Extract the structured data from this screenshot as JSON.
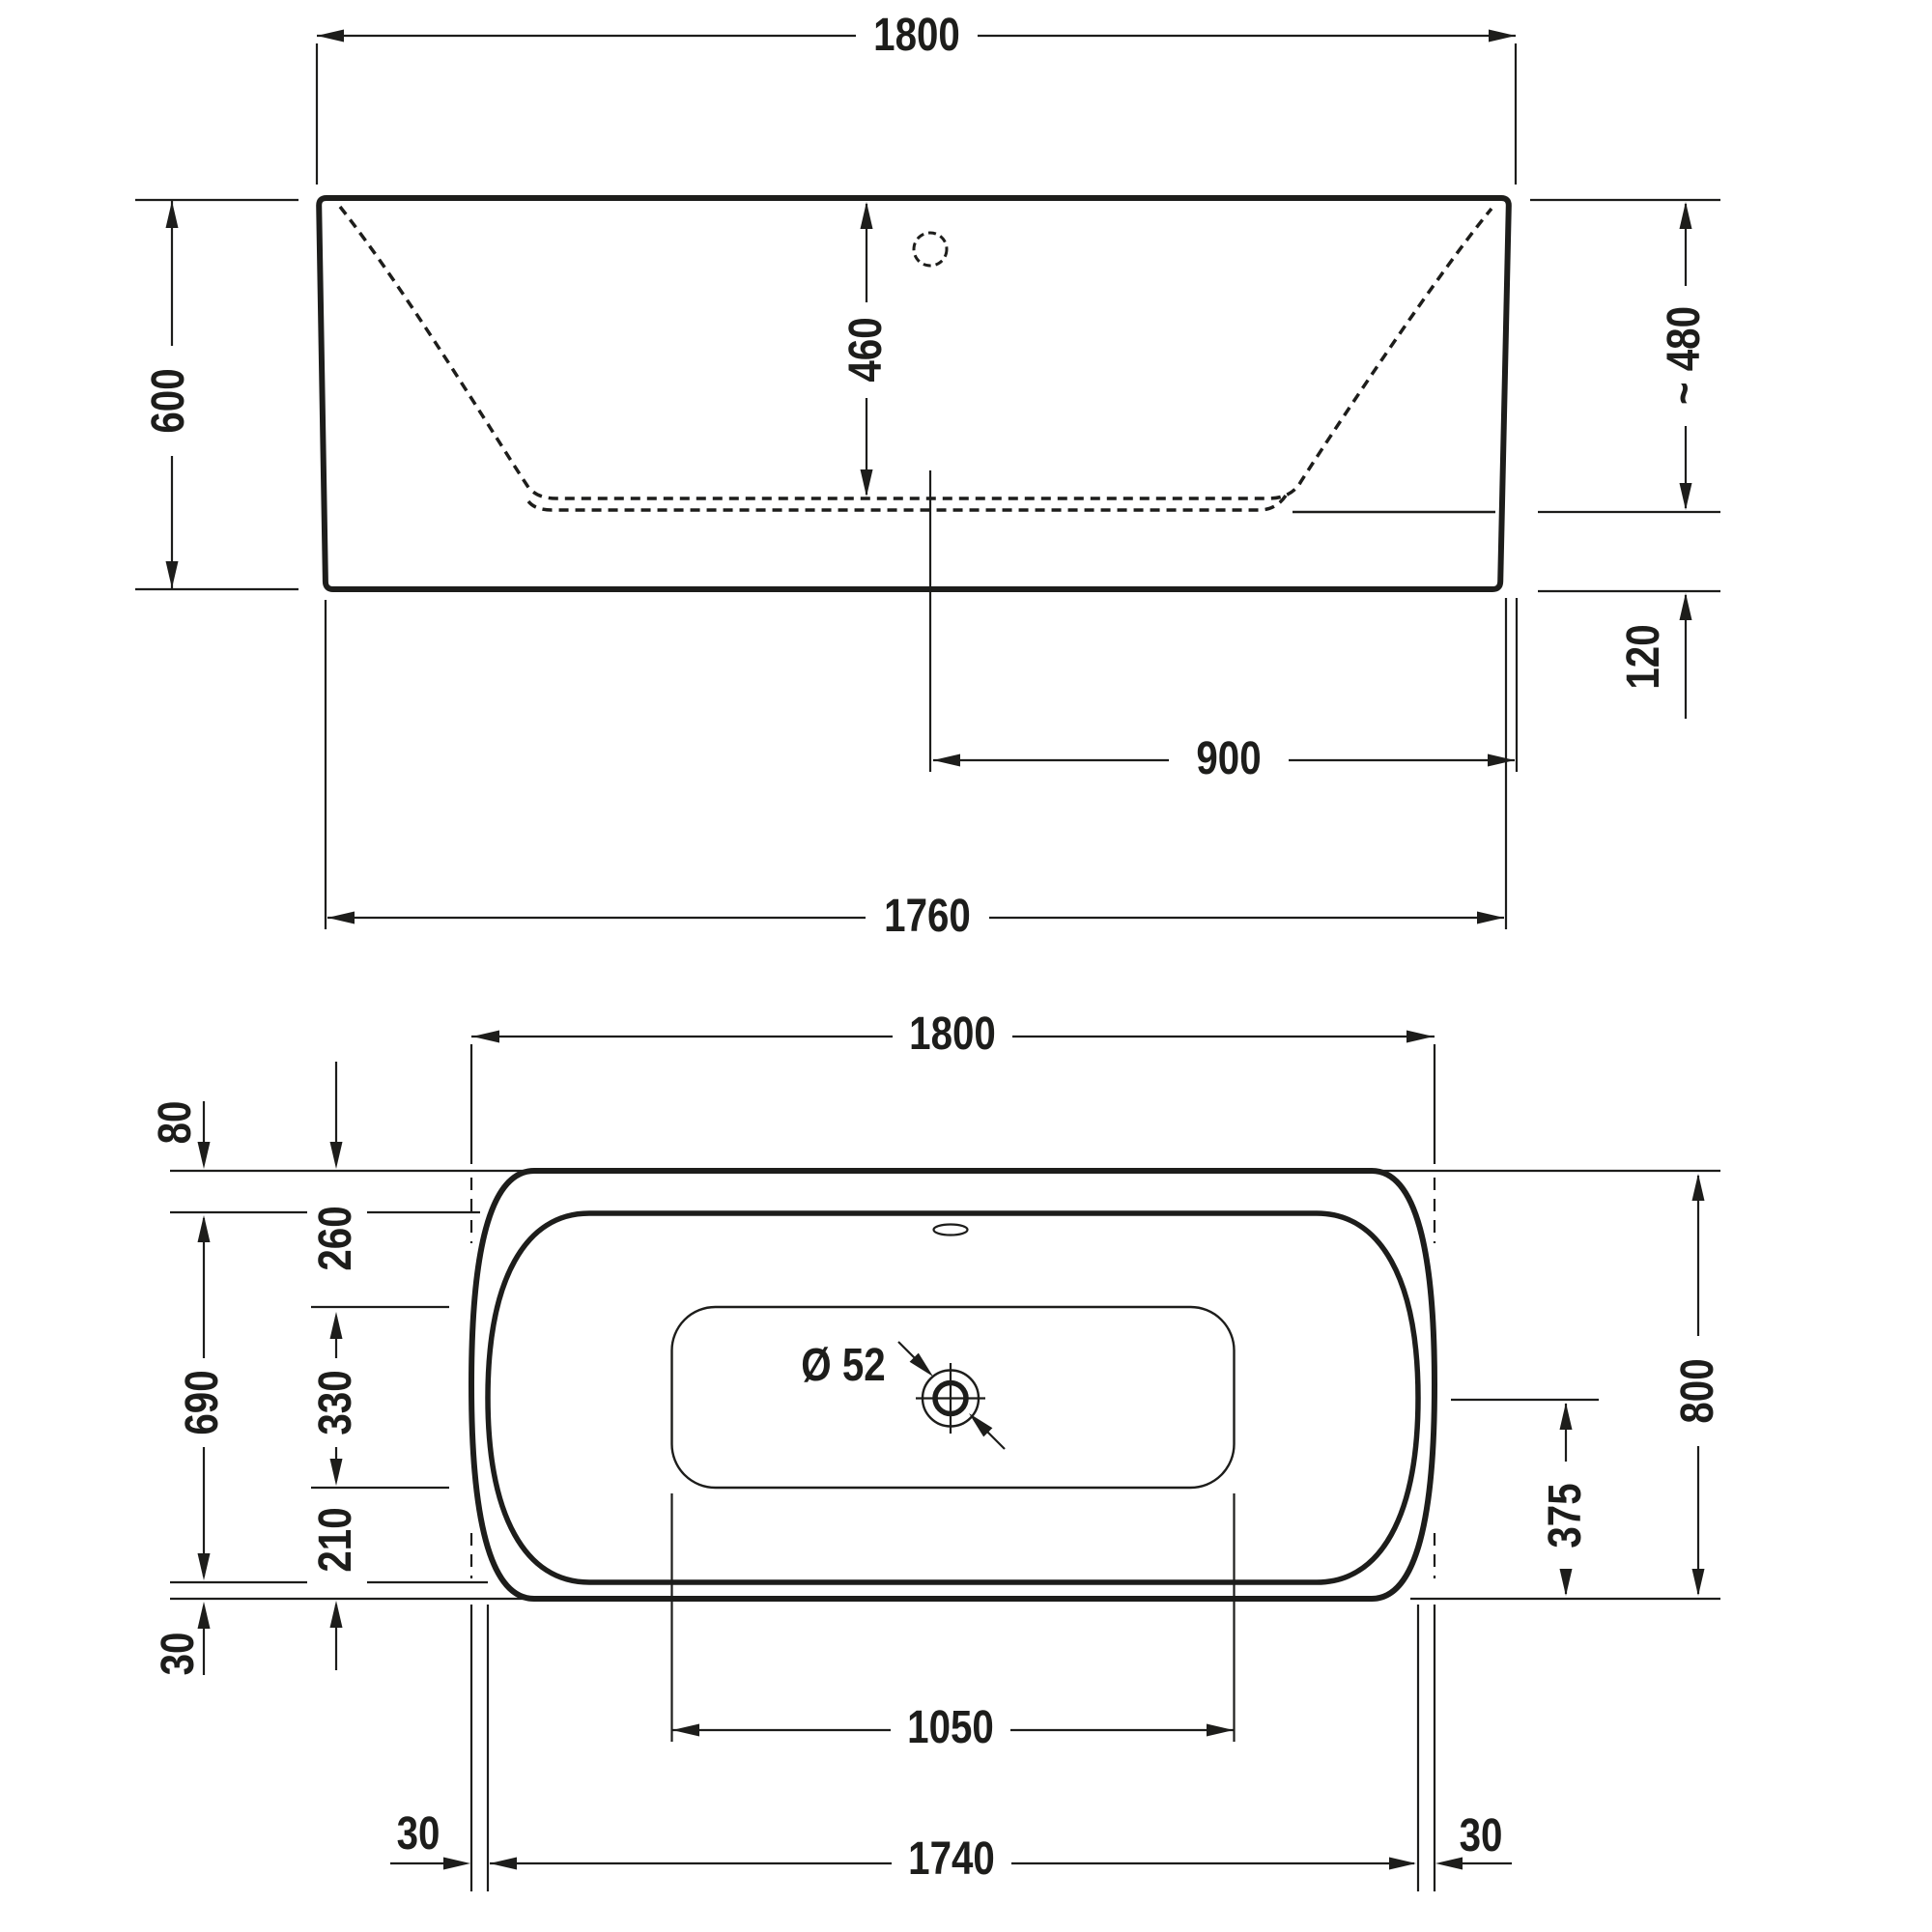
{
  "page": {
    "background": "#ffffff",
    "line_color": "#1d1d1b",
    "description": "Bathtub technical dimension drawing: front elevation (top) and plan view (bottom)"
  },
  "elevation_view": {
    "dims": {
      "overall_width": "1800",
      "overall_height": "600",
      "depth_to_floor": "460",
      "approx_height_right": "~ 480",
      "base_height": "120",
      "center_to_right_edge": "900",
      "base_width": "1760"
    }
  },
  "plan_view": {
    "dims": {
      "overall_length": "1800",
      "rim_top_offset": "80",
      "top_to_floor": "260",
      "rim_opening_width": "690",
      "floor_width": "330",
      "floor_to_bottom": "210",
      "rim_bottom_offset": "30",
      "overall_width": "800",
      "drain_center_to_bottom": "375",
      "drain_diameter": "Ø 52",
      "floor_length": "1050",
      "rim_inset_left": "30",
      "rim_opening_length": "1740",
      "rim_inset_right": "30"
    }
  }
}
